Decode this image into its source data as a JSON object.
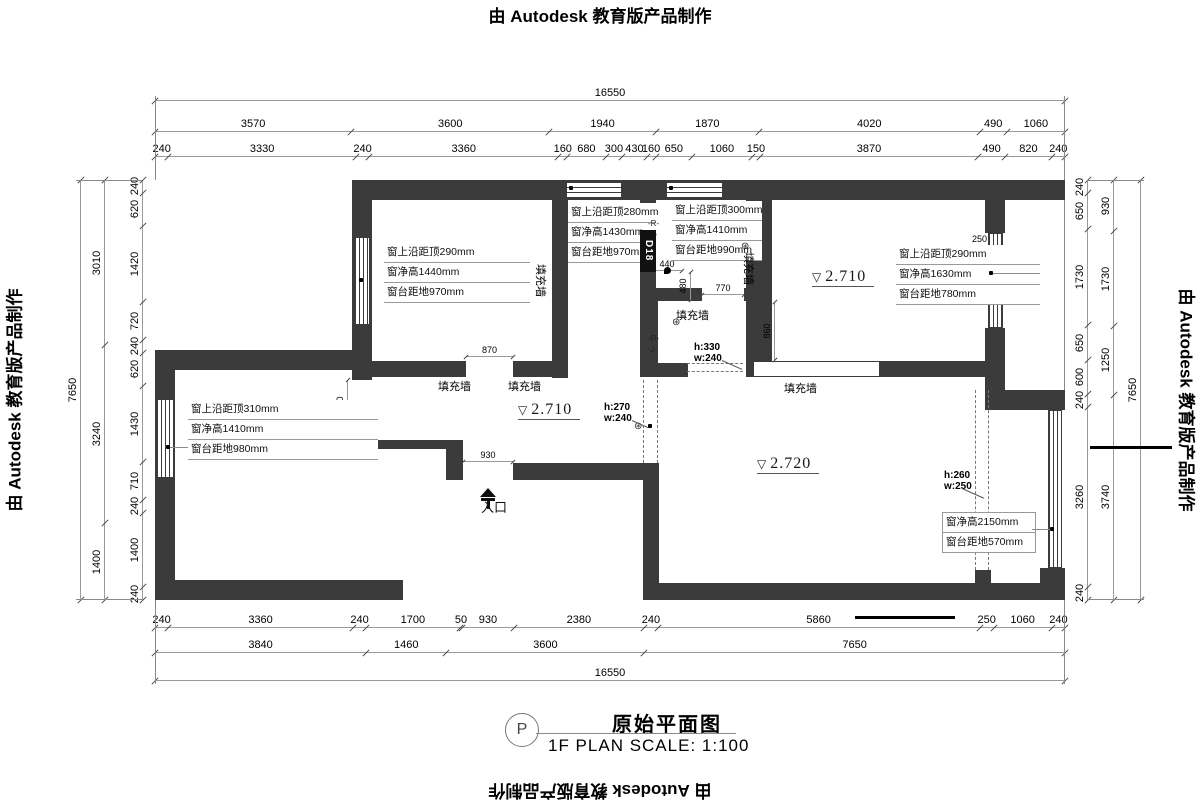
{
  "banner": {
    "text": "由 Autodesk 教育版产品制作"
  },
  "title": {
    "bubble": "P",
    "name": "原始平面图",
    "scale": "1F PLAN SCALE: 1:100"
  },
  "colors": {
    "wall": "#3b3b3b",
    "dimline": "#9a9a9a"
  },
  "dims": {
    "top_overall": [
      "16550"
    ],
    "top_row2": [
      "3570",
      "3600",
      "1940",
      "1870",
      "4020",
      "490",
      "1060"
    ],
    "top_row3": [
      "240",
      "3330",
      "240",
      "3360",
      "160",
      "680",
      "300",
      "430",
      "160",
      "650",
      "1060",
      "150",
      "3870",
      "490",
      "820",
      "240"
    ],
    "bottom_row1": [
      "240",
      "3360",
      "240",
      "1700",
      "50",
      "930",
      "2380",
      "240",
      "5860",
      "250",
      "1060",
      "240"
    ],
    "bottom_row2": [
      "3840",
      "1460",
      "3600",
      "7650"
    ],
    "bottom_overall": [
      "16550"
    ],
    "left_outer": [
      "7650"
    ],
    "left_mid": [
      "3010",
      "3240",
      "1400"
    ],
    "left_inner": [
      "240",
      "620",
      "1420",
      "720",
      "240",
      "620",
      "1430",
      "710",
      "240",
      "1400",
      "240"
    ],
    "right_inner": [
      "240",
      "650",
      "1730",
      "650",
      "600",
      "240",
      "3260",
      "240"
    ],
    "right_mid": [
      "930",
      "1730",
      "1250",
      "3740"
    ],
    "right_outer": [
      "7650"
    ],
    "inner": {
      "tl_870": [
        "870"
      ],
      "entry_930": [
        "930"
      ],
      "sr_770": [
        "770"
      ],
      "sr_440": [
        "440"
      ],
      "sr_480": [
        "480"
      ],
      "tr_860": [
        "860"
      ],
      "bl_870": [
        "870"
      ]
    },
    "tr_250": "250"
  },
  "annotations": {
    "room_tl": [
      "窗上沿距顶290mm",
      "窗净高1440mm",
      "窗台距地970mm"
    ],
    "room_mid": [
      "窗上沿距顶280mm",
      "窗净高1430mm",
      "窗台距地970mm"
    ],
    "room_small": [
      "窗上沿距顶300mm",
      "窗净高1410mm",
      "窗台距地990mm"
    ],
    "room_tr": [
      "窗上沿距顶290mm",
      "窗净高1630mm",
      "窗台距地780mm"
    ],
    "room_bl": [
      "窗上沿距顶310mm",
      "窗净高1410mm",
      "窗台距地980mm"
    ],
    "room_br": [
      "窗净高2150mm",
      "窗台距地570mm"
    ]
  },
  "labels": {
    "fill_wall": "填充墙",
    "entrance": "入口",
    "d18": "D18",
    "elev_hall": "2.710",
    "elev_tr": "2.710",
    "elev_br": "2.720",
    "tri": "▽",
    "h330": "h:330",
    "w240a": "w:240",
    "h270": "h:270",
    "w240b": "w:240",
    "h260": "h:260",
    "w250": "w:250",
    "marker_r": "-R-",
    "marker_j": "-J-",
    "star": "⊛"
  }
}
